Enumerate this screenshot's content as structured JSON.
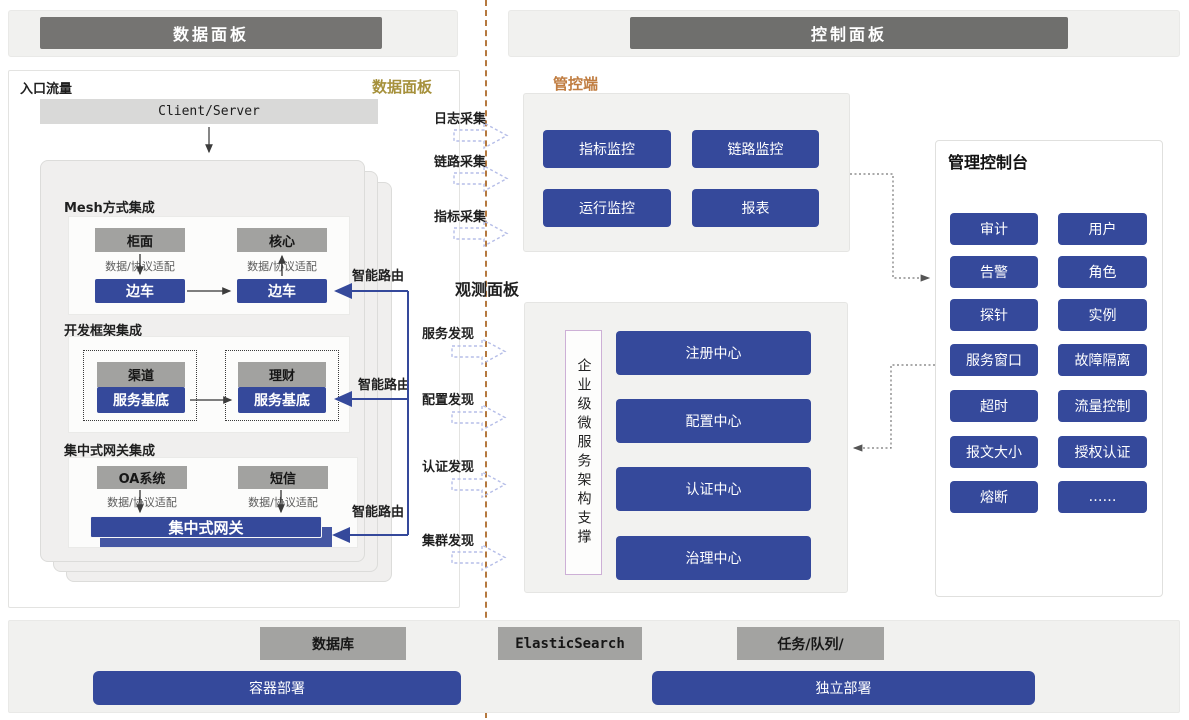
{
  "colors": {
    "blue": "#35499B",
    "gold": "#A6913C",
    "orange": "#C07D41",
    "divider": "#B5793F"
  },
  "header": {
    "left": "数据面板",
    "right": "控制面板"
  },
  "data_plane": {
    "entry_label": "入口流量",
    "corner_label": "数据面板",
    "client_server": "Client/Server",
    "smart_route_label": "智能路由",
    "mesh": {
      "title": "Mesh方式集成",
      "top_left": "柜面",
      "top_right": "核心",
      "adapter": "数据/协议适配",
      "bottom_left": "边车",
      "bottom_right": "边车"
    },
    "framework": {
      "title": "开发框架集成",
      "top_left": "渠道",
      "top_right": "理财",
      "bottom_left": "服务基底",
      "bottom_right": "服务基底"
    },
    "gateway": {
      "title": "集中式网关集成",
      "top_left": "OA系统",
      "top_right": "短信",
      "adapter": "数据/协议适配",
      "bar": "集中式网关"
    }
  },
  "flows": {
    "collect": [
      "日志采集",
      "链路采集",
      "指标采集"
    ],
    "observe_title": "观测面板",
    "discover": [
      "服务发现",
      "配置发现",
      "认证发现",
      "集群发现"
    ]
  },
  "control_plane": {
    "label": "管控端",
    "monitor_buttons": [
      "指标监控",
      "链路监控",
      "运行监控",
      "报表"
    ],
    "support_label": "企业级微服务架构支撑",
    "centers": [
      "注册中心",
      "配置中心",
      "认证中心",
      "治理中心"
    ],
    "console": {
      "title": "管理控制台",
      "buttons": [
        "审计",
        "用户",
        "告警",
        "角色",
        "探针",
        "实例",
        "服务窗口",
        "故障隔离",
        "超时",
        "流量控制",
        "报文大小",
        "授权认证",
        "熔断",
        "……"
      ]
    }
  },
  "infrastructure": {
    "gray": [
      "数据库",
      "ElasticSearch",
      "任务/队列/"
    ],
    "blue": [
      "容器部署",
      "独立部署"
    ]
  }
}
